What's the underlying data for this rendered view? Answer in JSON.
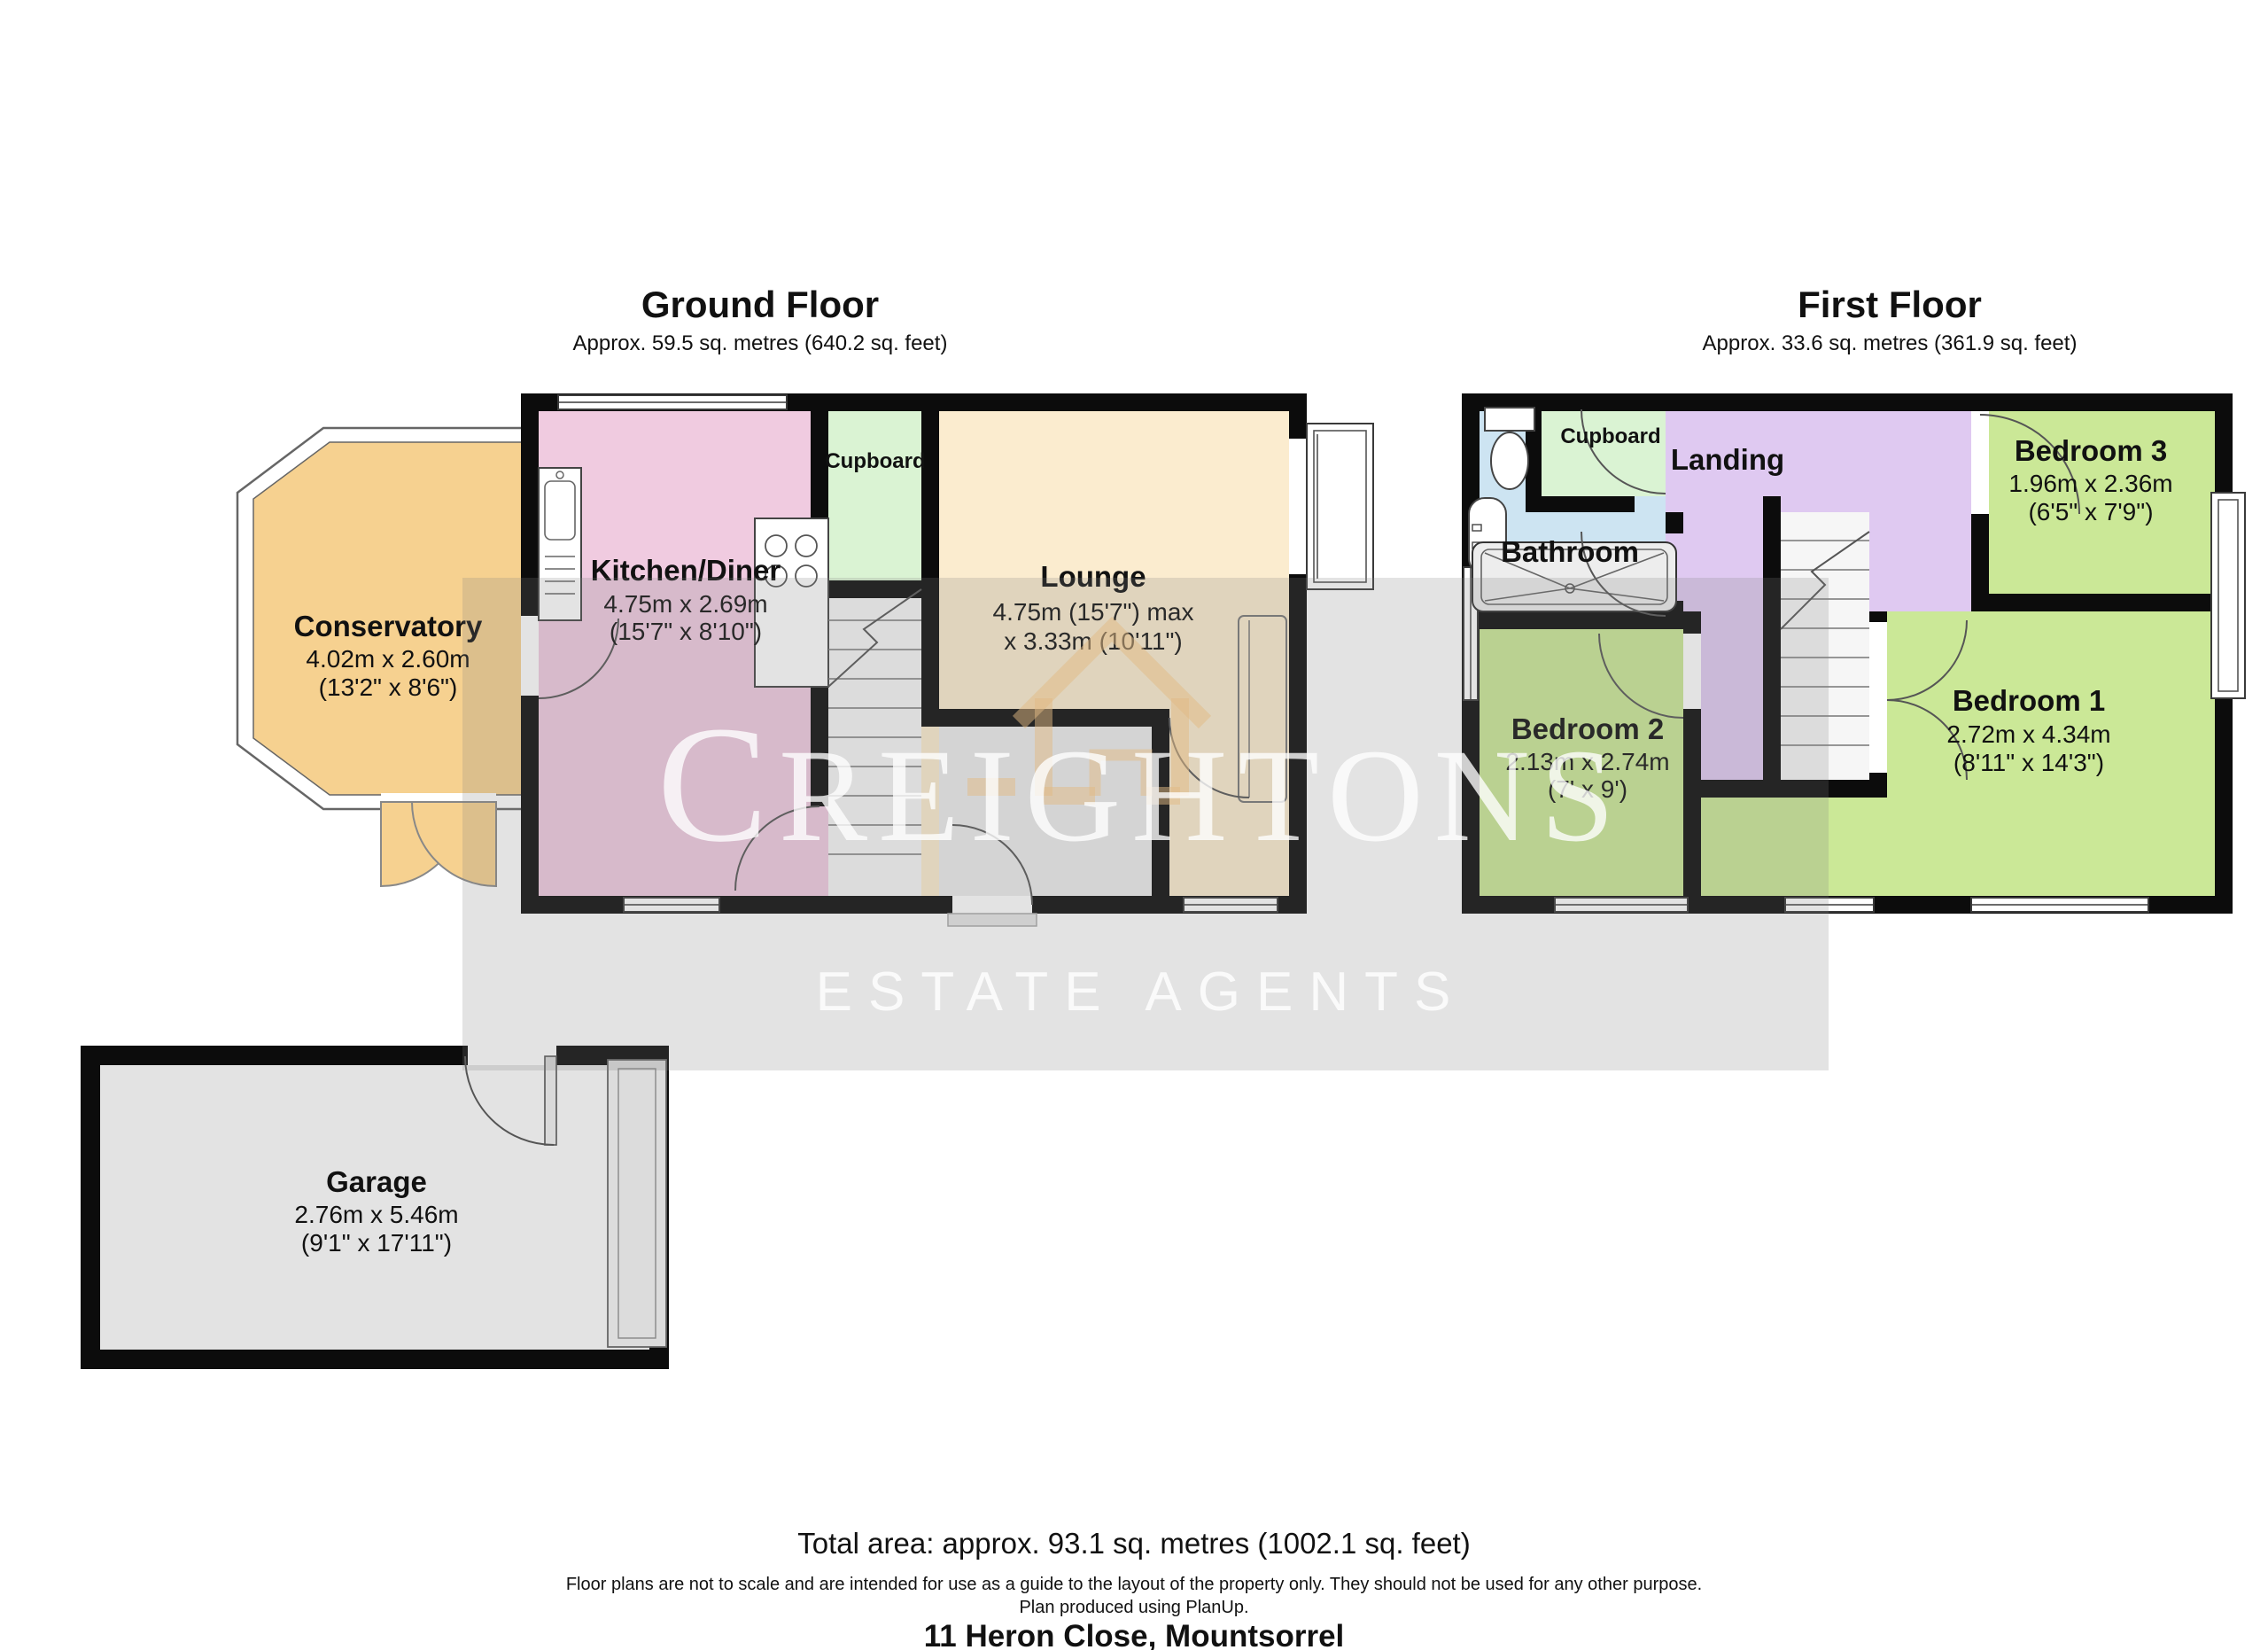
{
  "header": {
    "ground_floor": {
      "title": "Ground Floor",
      "area": "Approx. 59.5 sq. metres (640.2 sq. feet)"
    },
    "first_floor": {
      "title": "First Floor",
      "area": "Approx. 33.6 sq. metres (361.9 sq. feet)"
    }
  },
  "rooms": {
    "conservatory": {
      "name": "Conservatory",
      "metric": "4.02m x 2.60m",
      "imperial": "(13'2\" x 8'6\")"
    },
    "kitchen": {
      "name": "Kitchen/Diner",
      "metric": "4.75m x 2.69m",
      "imperial": "(15'7\" x 8'10\")"
    },
    "cupboard_ground": {
      "name": "Cupboard"
    },
    "lounge": {
      "name": "Lounge",
      "metric": "4.75m (15'7\") max",
      "imperial": "x 3.33m (10'11\")"
    },
    "garage": {
      "name": "Garage",
      "metric": "2.76m x 5.46m",
      "imperial": "(9'1\" x 17'11\")"
    },
    "bathroom": {
      "name": "Bathroom"
    },
    "cupboard_first": {
      "name": "Cupboard"
    },
    "landing": {
      "name": "Landing"
    },
    "bedroom1": {
      "name": "Bedroom 1",
      "metric": "2.72m x 4.34m",
      "imperial": "(8'11\" x 14'3\")"
    },
    "bedroom2": {
      "name": "Bedroom 2",
      "metric": "2.13m x 2.74m",
      "imperial": "(7' x 9')"
    },
    "bedroom3": {
      "name": "Bedroom 3",
      "metric": "1.96m x 2.36m",
      "imperial": "(6'5\" x 7'9\")"
    }
  },
  "watermark": {
    "brand_initial": "C",
    "brand_rest": "REIGHTONS",
    "tagline": "ESTATE AGENTS"
  },
  "footer": {
    "total_area": "Total area: approx. 93.1 sq. metres (1002.1 sq. feet)",
    "disclaimer": "Floor plans are not to scale and are intended for use as a guide to the layout of the property only. They should not be used for any other purpose.",
    "produced": "Plan produced using PlanUp.",
    "address": "11 Heron Close, Mountsorrel"
  },
  "colors": {
    "conservatory": "#f6d190",
    "kitchen": "#f0cbe0",
    "lounge": "#fbeccf",
    "cupboard": "#daf3d3",
    "bathroom": "#cde4f2",
    "landing": "#dfc9f1",
    "bedroom": "#cbe897",
    "garage": "#e3e3e3",
    "hall": "#ececec"
  }
}
